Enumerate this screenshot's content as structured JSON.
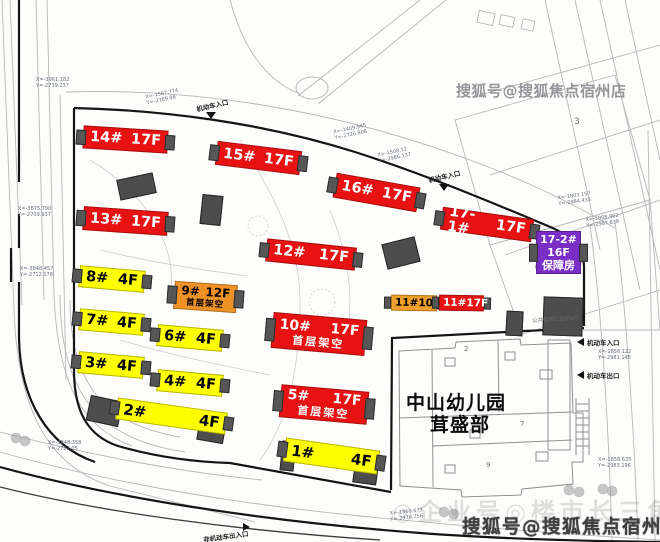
{
  "title": "residential-site-plan",
  "colors": {
    "highrise_red": "#e81212",
    "lowrise_yellow": "#ffff00",
    "podium_orange": "#ef9226",
    "welfare_purple": "#7a2ec6",
    "structure_gray": "#4d4d4d"
  },
  "buildings": [
    {
      "id": "14",
      "label": "14#",
      "floors": "17F",
      "type": "red",
      "x": 83,
      "y": 128,
      "w": 85,
      "h": 23,
      "rot": 3.5
    },
    {
      "id": "15",
      "label": "15#",
      "floors": "17F",
      "type": "red",
      "x": 216,
      "y": 146,
      "w": 85,
      "h": 24,
      "rot": 7
    },
    {
      "id": "16",
      "label": "16#",
      "floors": "17F",
      "type": "red",
      "x": 334,
      "y": 180,
      "w": 85,
      "h": 25,
      "rot": 10
    },
    {
      "id": "17-1",
      "label": "17-1#",
      "floors": "17F",
      "type": "red",
      "x": 441,
      "y": 213,
      "w": 92,
      "h": 23,
      "rot": 8
    },
    {
      "id": "13",
      "label": "13#",
      "floors": "17F",
      "type": "red",
      "x": 83,
      "y": 209,
      "w": 85,
      "h": 24,
      "rot": 4
    },
    {
      "id": "12",
      "label": "12#",
      "floors": "17F",
      "type": "red",
      "x": 266,
      "y": 243,
      "w": 90,
      "h": 23,
      "rot": 6
    },
    {
      "id": "17-2",
      "label": "17-2#",
      "floors": "16F",
      "note": "保障房",
      "type": "purple",
      "x": 536,
      "y": 231,
      "w": 45,
      "h": 43,
      "rot": 0
    },
    {
      "id": "8",
      "label": "8#",
      "floors": "4F",
      "type": "yellow",
      "x": 79,
      "y": 268,
      "w": 66,
      "h": 22,
      "rot": 5
    },
    {
      "id": "9",
      "label": "9#",
      "floors": "12F",
      "note": "首层架空",
      "type": "orange2",
      "x": 174,
      "y": 283,
      "w": 63,
      "h": 28,
      "rot": 4
    },
    {
      "id": "7",
      "label": "7#",
      "floors": "4F",
      "type": "yellow",
      "x": 79,
      "y": 311,
      "w": 65,
      "h": 22,
      "rot": 5
    },
    {
      "id": "6",
      "label": "6#",
      "floors": "4F",
      "type": "yellow",
      "x": 157,
      "y": 327,
      "w": 66,
      "h": 22,
      "rot": 5
    },
    {
      "id": "10",
      "label": "10#",
      "floors": "17F",
      "note": "首层架空",
      "type": "red2",
      "x": 272,
      "y": 316,
      "w": 94,
      "h": 36,
      "rot": 5
    },
    {
      "id": "11a",
      "label": "11#",
      "floors": "10F",
      "type": "sm-orange",
      "x": 391,
      "y": 295,
      "w": 46,
      "h": 16,
      "rot": 1
    },
    {
      "id": "11b",
      "label": "11#",
      "floors": "17F",
      "type": "sm-red",
      "x": 439,
      "y": 295,
      "w": 45,
      "h": 16,
      "rot": 1
    },
    {
      "id": "3",
      "label": "3#",
      "floors": "4F",
      "type": "yellow",
      "x": 78,
      "y": 354,
      "w": 66,
      "h": 22,
      "rot": 5
    },
    {
      "id": "4",
      "label": "4#",
      "floors": "4F",
      "type": "yellow",
      "x": 157,
      "y": 372,
      "w": 66,
      "h": 22,
      "rot": 5
    },
    {
      "id": "5",
      "label": "5#",
      "floors": "17F",
      "note": "首层架空",
      "type": "red2",
      "x": 280,
      "y": 388,
      "w": 88,
      "h": 33,
      "rot": 5
    },
    {
      "id": "2",
      "label": "2#",
      "floors": "4F",
      "type": "yellow wide",
      "x": 116,
      "y": 405,
      "w": 111,
      "h": 22,
      "rot": 8
    },
    {
      "id": "1",
      "label": "1#",
      "floors": "4F",
      "type": "yellow wide",
      "x": 284,
      "y": 444,
      "w": 95,
      "h": 24,
      "rot": 8
    }
  ],
  "structures": [
    {
      "x": 118,
      "y": 176,
      "w": 37,
      "h": 21,
      "rot": -12
    },
    {
      "x": 201,
      "y": 195,
      "w": 21,
      "h": 30,
      "rot": 6
    },
    {
      "x": 384,
      "y": 240,
      "w": 34,
      "h": 26,
      "rot": -14
    },
    {
      "x": 506,
      "y": 311,
      "w": 17,
      "h": 25,
      "rot": 3
    },
    {
      "x": 536,
      "y": 258,
      "w": 45,
      "h": 12,
      "rot": 4
    },
    {
      "x": 543,
      "y": 297,
      "w": 40,
      "h": 39,
      "rot": 2
    },
    {
      "x": 88,
      "y": 398,
      "w": 33,
      "h": 26,
      "rot": 12
    },
    {
      "x": 198,
      "y": 419,
      "w": 27,
      "h": 23,
      "rot": 10
    },
    {
      "x": 281,
      "y": 441,
      "w": 14,
      "h": 30,
      "rot": 6
    },
    {
      "x": 354,
      "y": 457,
      "w": 24,
      "h": 27,
      "rot": 8
    }
  ],
  "kindergarten": {
    "line1": "中山幼儿园",
    "line2": "茸盛部"
  },
  "entrances": [
    {
      "text": "机动车入口",
      "x": 196,
      "y": 100,
      "rot": -13,
      "arrow": "down",
      "ax": 206,
      "ay": 112
    },
    {
      "text": "机动车入口",
      "x": 428,
      "y": 171,
      "rot": -13,
      "arrow": "down",
      "ax": 439,
      "ay": 184
    },
    {
      "text": "机动车入口",
      "x": 587,
      "y": 337,
      "rot": 0,
      "arrow": "left",
      "ax": 577,
      "ay": 338
    },
    {
      "text": "机动车出口",
      "x": 587,
      "y": 370,
      "rot": 0,
      "arrow": "left",
      "ax": 577,
      "ay": 371
    },
    {
      "text": "非机动车出入口",
      "x": 203,
      "y": 531,
      "rot": -8,
      "arrow": "right",
      "ax": 243,
      "ay": 523
    }
  ],
  "annotations": [
    {
      "l1": "X=-3961.182",
      "l2": "Y=-2739.237",
      "x": 36,
      "y": 78,
      "rot": 0
    },
    {
      "l1": "X=-1567.774",
      "l2": "Y=-2789.98",
      "x": 146,
      "y": 92,
      "rot": -12
    },
    {
      "l1": "X=-1409.945",
      "l2": "Y=-2726.908",
      "x": 334,
      "y": 127,
      "rot": -12
    },
    {
      "l1": "X=-1508.12",
      "l2": "Y=-2986.137",
      "x": 378,
      "y": 150,
      "rot": -12
    },
    {
      "l1": "X=-1803.157",
      "l2": "Y=-2984.433",
      "x": 558,
      "y": 194,
      "rot": -8
    },
    {
      "l1": "X=-1808.962",
      "l2": "Y=-2987.838",
      "x": 586,
      "y": 216,
      "rot": -8
    },
    {
      "l1": "X=-3875.790",
      "l2": "Y=-2709.937",
      "x": 18,
      "y": 207,
      "rot": 0
    },
    {
      "l1": "X=-3848.457",
      "l2": "Y=-2712.178",
      "x": 20,
      "y": 267,
      "rot": 0
    },
    {
      "l1": "X=-3848.358",
      "l2": "Y=-2762.05",
      "x": 48,
      "y": 441,
      "rot": 0
    },
    {
      "l1": "X=-1860.673",
      "l2": "Y=-2976.756",
      "x": 390,
      "y": 510,
      "rot": -6
    },
    {
      "l1": "X=-1856.122",
      "l2": "Y=-2981.145",
      "x": 598,
      "y": 350,
      "rot": 0
    },
    {
      "l1": "X=-1858.635",
      "l2": "Y=-2983.196",
      "x": 598,
      "y": 458,
      "rot": 0
    }
  ],
  "misc_texts": [
    {
      "text": "公共型房(1500㎡)",
      "x": 532,
      "y": 315,
      "fs": 5.5,
      "rot": -3
    },
    {
      "text": "3",
      "x": 574,
      "y": 117,
      "fs": 9,
      "rot": 0
    },
    {
      "text": "2",
      "x": 464,
      "y": 345,
      "fs": 7,
      "rot": 0
    },
    {
      "text": "7",
      "x": 520,
      "y": 420,
      "fs": 7,
      "rot": 0
    },
    {
      "text": "9",
      "x": 486,
      "y": 461,
      "fs": 7,
      "rot": 0
    }
  ],
  "watermarks": {
    "top_right": "搜狐号@搜狐焦点宿州店",
    "bottom": "搜狐号@搜狐焦点宿州店",
    "bottom_faint": "◎企业号◎楼市长三角"
  }
}
